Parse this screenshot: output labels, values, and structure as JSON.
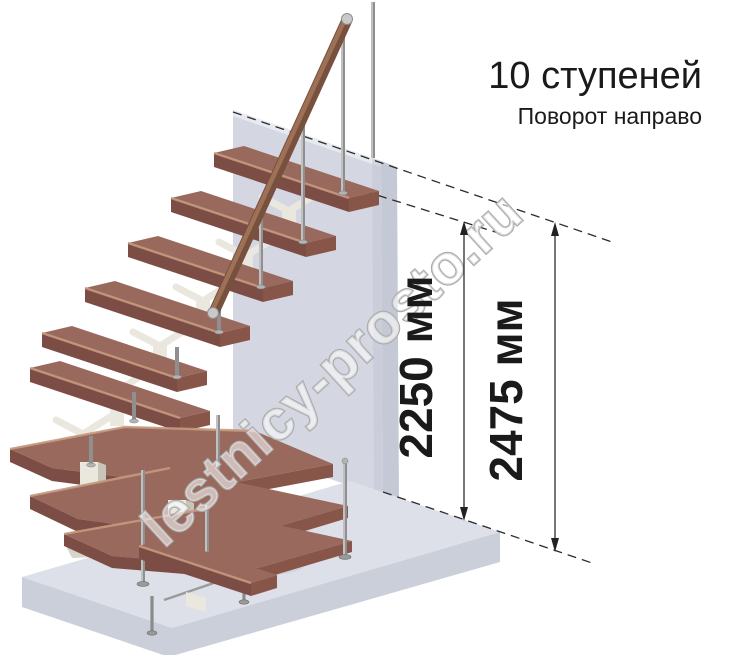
{
  "title": {
    "steps": "10 ступеней",
    "turn": "Поворот направо"
  },
  "dimensions": {
    "inner": "2250 мм",
    "outer": "2475 мм"
  },
  "watermark": "lestnicy-prosto.ru",
  "colors": {
    "tread_top": "#9a695d",
    "tread_front": "#7c4d44",
    "tread_side": "#885549",
    "nose_highlight": "#c49a7e",
    "wall_front": "#d4d7e2",
    "wall_side": "#c5c9d5",
    "floor_top": "#dee0e9",
    "floor_front": "#cbcfda",
    "support_cream": "#eae7df",
    "support_shadow": "#c9c4b8",
    "metal_light": "#d6d6d6",
    "metal_dark": "#8f8f8f",
    "handrail_wood": "#77503e",
    "annotation": "#1a1a1a",
    "watermark_stroke": "#ababab"
  }
}
